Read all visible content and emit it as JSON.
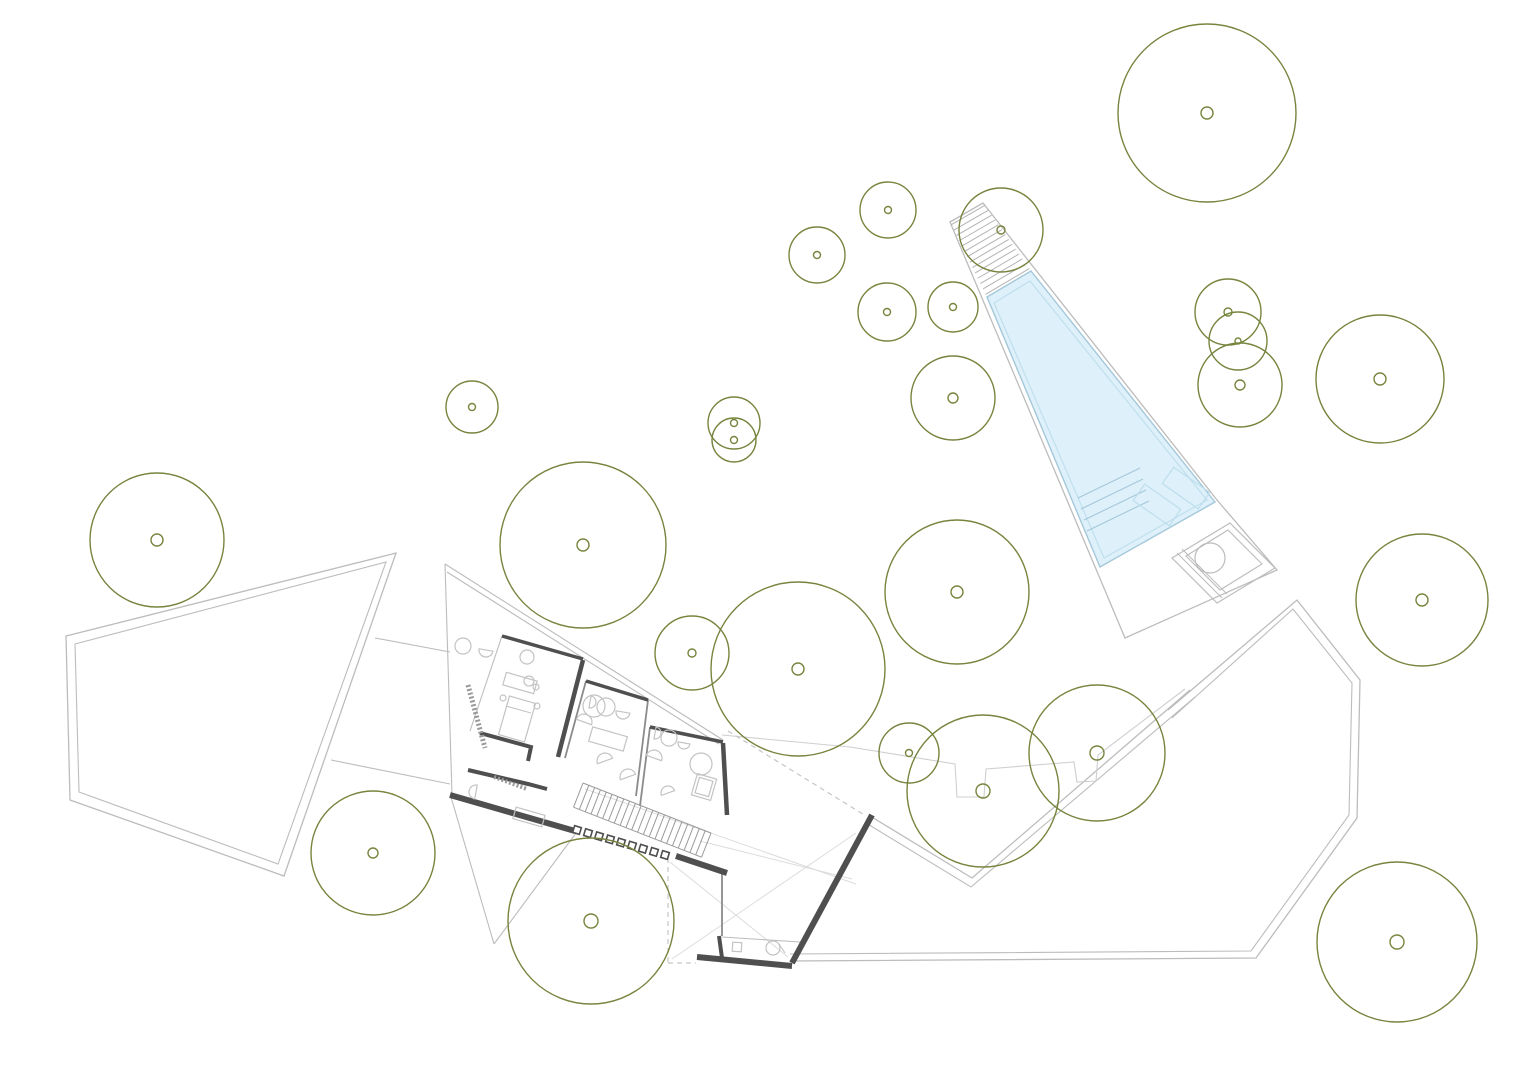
{
  "canvas": {
    "width": 1536,
    "height": 1086,
    "background": "#ffffff"
  },
  "colors": {
    "tree": "#76853e",
    "site": "#bcbcbc",
    "site_light": "#cfcfcf",
    "faint": "#dcdcdc",
    "dash": "#c6c6c6",
    "wall_dark": "#4f4f4f",
    "wall_med": "#8b8b8b",
    "furniture": "#c3c3c3",
    "water_fill": "#def0f9",
    "water_stroke": "#a4c8da",
    "water_inner": "#bedeed",
    "hatch": "#b3b3b3",
    "stair": "#9a9a9a"
  },
  "trees": [
    {
      "cx": 1207,
      "cy": 113,
      "r": 89,
      "dot": 6
    },
    {
      "cx": 888,
      "cy": 210,
      "r": 28,
      "dot": 3.5
    },
    {
      "cx": 817,
      "cy": 255,
      "r": 28,
      "dot": 3.5
    },
    {
      "cx": 887,
      "cy": 312,
      "r": 29,
      "dot": 3.5
    },
    {
      "cx": 953,
      "cy": 307,
      "r": 25,
      "dot": 3.5
    },
    {
      "cx": 1001,
      "cy": 230,
      "r": 42,
      "dot": 4
    },
    {
      "cx": 953,
      "cy": 398,
      "r": 42,
      "dot": 5
    },
    {
      "cx": 734,
      "cy": 423,
      "r": 26,
      "dot": 3.5
    },
    {
      "cx": 734,
      "cy": 440,
      "r": 22,
      "dot": 3.5
    },
    {
      "cx": 472,
      "cy": 407,
      "r": 26,
      "dot": 3.5
    },
    {
      "cx": 1228,
      "cy": 312,
      "r": 33,
      "dot": 4
    },
    {
      "cx": 1238,
      "cy": 341,
      "r": 29,
      "dot": 3
    },
    {
      "cx": 1240,
      "cy": 385,
      "r": 42,
      "dot": 5
    },
    {
      "cx": 1380,
      "cy": 379,
      "r": 64,
      "dot": 6
    },
    {
      "cx": 157,
      "cy": 540,
      "r": 67,
      "dot": 6
    },
    {
      "cx": 583,
      "cy": 545,
      "r": 83,
      "dot": 6
    },
    {
      "cx": 957,
      "cy": 592,
      "r": 72,
      "dot": 6
    },
    {
      "cx": 1422,
      "cy": 600,
      "r": 66,
      "dot": 6
    },
    {
      "cx": 798,
      "cy": 669,
      "r": 87,
      "dot": 6
    },
    {
      "cx": 692,
      "cy": 653,
      "r": 37,
      "dot": 4
    },
    {
      "cx": 983,
      "cy": 791,
      "r": 76,
      "dot": 7
    },
    {
      "cx": 1097,
      "cy": 753,
      "r": 68,
      "dot": 7
    },
    {
      "cx": 909,
      "cy": 753,
      "r": 30,
      "dot": 3.5
    },
    {
      "cx": 373,
      "cy": 853,
      "r": 62,
      "dot": 5
    },
    {
      "cx": 591,
      "cy": 921,
      "r": 83,
      "dot": 7
    },
    {
      "cx": 1397,
      "cy": 942,
      "r": 80,
      "dot": 7
    }
  ],
  "site": {
    "left_terrace_outer": [
      [
        66,
        636
      ],
      [
        396,
        553
      ],
      [
        284,
        876
      ],
      [
        70,
        800
      ]
    ],
    "left_terrace_inner": [
      [
        75,
        644
      ],
      [
        386,
        562
      ],
      [
        278,
        864
      ],
      [
        79,
        792
      ]
    ],
    "path_lines": [
      [
        [
          375,
          638
        ],
        [
          450,
          652
        ]
      ],
      [
        [
          331,
          760
        ],
        [
          450,
          784
        ]
      ]
    ],
    "right_terrace_outer": [
      [
        1168,
        710
      ],
      [
        1297,
        600
      ],
      [
        1360,
        680
      ],
      [
        1357,
        818
      ],
      [
        1256,
        958
      ],
      [
        790,
        961
      ]
    ],
    "right_terrace_inner": [
      [
        1172,
        718
      ],
      [
        1293,
        609
      ],
      [
        1352,
        683
      ],
      [
        1349,
        815
      ],
      [
        1251,
        951
      ],
      [
        790,
        954
      ]
    ],
    "upper_edge_outer": [
      [
        870,
        816
      ],
      [
        972,
        878
      ],
      [
        1190,
        690
      ]
    ],
    "upper_edge_inner": [
      [
        866,
        823
      ],
      [
        971,
        887
      ],
      [
        1195,
        697
      ]
    ],
    "notched_edge": [
      [
        722,
        735
      ],
      [
        850,
        747
      ],
      [
        955,
        764
      ],
      [
        957,
        797
      ],
      [
        984,
        797
      ],
      [
        986,
        769
      ],
      [
        1074,
        762
      ],
      [
        1077,
        782
      ],
      [
        1096,
        781
      ],
      [
        1098,
        755
      ],
      [
        1185,
        689
      ]
    ],
    "faint_lines": [
      [
        [
          585,
          789
        ],
        [
          856,
          884
        ]
      ],
      [
        [
          700,
          841
        ],
        [
          852,
          879
        ]
      ],
      [
        [
          670,
          862
        ],
        [
          788,
          957
        ]
      ],
      [
        [
          672,
          959
        ],
        [
          856,
          833
        ]
      ]
    ],
    "dashed_lines": [
      [
        [
          728,
          731
        ],
        [
          866,
          816
        ]
      ],
      [
        [
          668,
          858
        ],
        [
          668,
          963
        ]
      ],
      [
        [
          668,
          963
        ],
        [
          696,
          963
        ]
      ],
      [
        [
          977,
          281
        ],
        [
          1020,
          259
        ]
      ]
    ]
  },
  "pool": {
    "deck": [
      [
        950,
        222
      ],
      [
        983,
        203
      ],
      [
        1217,
        500
      ],
      [
        1277,
        570
      ],
      [
        1125,
        638
      ]
    ],
    "water": [
      [
        987,
        297
      ],
      [
        1031,
        271
      ],
      [
        1215,
        502
      ],
      [
        1100,
        567
      ]
    ],
    "water_inner": [
      [
        994,
        303
      ],
      [
        1030,
        281
      ],
      [
        1207,
        500
      ],
      [
        1104,
        558
      ]
    ],
    "ramp_hatch": {
      "top_edge": [
        [
          950,
          222
        ],
        [
          983,
          203
        ]
      ],
      "bottom_edge": [
        [
          987,
          297
        ],
        [
          1031,
          271
        ]
      ],
      "lines": 14
    },
    "steps": [
      [
        [
          1078,
          498
        ],
        [
          1140,
          468
        ]
      ],
      [
        [
          1081,
          509
        ],
        [
          1143,
          479
        ]
      ],
      [
        [
          1084,
          520
        ],
        [
          1146,
          490
        ]
      ],
      [
        [
          1087,
          531
        ],
        [
          1149,
          501
        ]
      ]
    ],
    "benches": [
      {
        "cx": 1157,
        "cy": 505,
        "w": 20,
        "h": 44,
        "rot": -55
      },
      {
        "cx": 1186,
        "cy": 488,
        "w": 20,
        "h": 44,
        "rot": -55
      }
    ],
    "spa": {
      "outer": [
        [
          1172,
          558
        ],
        [
          1230,
          523
        ],
        [
          1275,
          568
        ],
        [
          1217,
          603
        ]
      ],
      "inner": [
        [
          1186,
          556
        ],
        [
          1228,
          530
        ],
        [
          1262,
          564
        ],
        [
          1220,
          590
        ]
      ],
      "circle": {
        "cx": 1210,
        "cy": 558,
        "r": 15
      },
      "lines": [
        [
          [
            1177,
            553
          ],
          [
            1222,
            598
          ]
        ],
        [
          [
            1182,
            549
          ],
          [
            1227,
            594
          ]
        ]
      ]
    }
  },
  "building": {
    "outline_lines": [
      [
        [
          445,
          564
        ],
        [
          723,
          740
        ]
      ],
      [
        [
          447,
          572
        ],
        [
          719,
          744
        ]
      ],
      [
        [
          445,
          564
        ],
        [
          452,
          795
        ]
      ],
      [
        [
          451,
          797
        ],
        [
          494,
          944
        ]
      ],
      [
        [
          494,
          944
        ],
        [
          576,
          833
        ]
      ],
      [
        [
          502,
          636
        ],
        [
          470,
          731
        ]
      ],
      [
        [
          722,
          937
        ],
        [
          800,
          942
        ]
      ]
    ],
    "medium_walls": [
      [
        [
          586,
          681
        ],
        [
          565,
          758
        ]
      ],
      [
        [
          648,
          700
        ],
        [
          636,
          796
        ]
      ],
      [
        [
          650,
          727
        ],
        [
          640,
          806
        ]
      ],
      [
        [
          722,
          874
        ],
        [
          722,
          936
        ]
      ]
    ],
    "thick_walls": [
      {
        "pts": [
          [
            502,
            636
          ],
          [
            583,
            659
          ]
        ],
        "w": 3.5
      },
      {
        "pts": [
          [
            583,
            660
          ],
          [
            558,
            757
          ]
        ],
        "w": 4.5
      },
      {
        "pts": [
          [
            480,
            733
          ],
          [
            531,
            747
          ],
          [
            528,
            761
          ]
        ],
        "w": 4
      },
      {
        "pts": [
          [
            468,
            770
          ],
          [
            528,
            784
          ],
          [
            547,
            789
          ]
        ],
        "w": 4
      },
      {
        "pts": [
          [
            586,
            681
          ],
          [
            648,
            700
          ]
        ],
        "w": 3.5
      },
      {
        "pts": [
          [
            650,
            727
          ],
          [
            723,
            742
          ]
        ],
        "w": 3.5
      },
      {
        "pts": [
          [
            723,
            743
          ],
          [
            727,
            815
          ]
        ],
        "w": 4.5
      },
      {
        "pts": [
          [
            450,
            795
          ],
          [
            575,
            831
          ]
        ],
        "w": 6
      },
      {
        "pts": [
          [
            676,
            856
          ],
          [
            727,
            873
          ]
        ],
        "w": 6
      },
      {
        "pts": [
          [
            872,
            815
          ],
          [
            792,
            963
          ]
        ],
        "w": 6
      },
      {
        "pts": [
          [
            697,
            957
          ],
          [
            792,
            966
          ]
        ],
        "w": 6
      },
      {
        "pts": [
          [
            719,
            936
          ],
          [
            722,
            958
          ]
        ],
        "w": 4
      }
    ],
    "hatched_strips": [
      {
        "pts": [
          [
            468,
            685
          ],
          [
            485,
            748
          ]
        ],
        "w": 5
      },
      {
        "pts": [
          [
            494,
            777
          ],
          [
            527,
            789
          ]
        ],
        "w": 4
      }
    ],
    "stairs": {
      "p1": [
        583,
        783
      ],
      "p2": [
        711,
        833
      ],
      "width": 26,
      "treads": 22
    },
    "columns": {
      "start": [
        577,
        830
      ],
      "end": [
        665,
        855
      ],
      "count": 9,
      "size": 7,
      "rot": 17
    },
    "furniture_circles": [
      [
        463,
        646,
        8
      ],
      [
        527,
        657,
        7
      ],
      [
        529,
        681,
        5
      ],
      [
        536,
        687,
        3
      ],
      [
        503,
        698,
        3
      ],
      [
        537,
        706,
        3
      ],
      [
        594,
        706,
        11
      ],
      [
        606,
        707,
        9
      ],
      [
        669,
        738,
        8
      ],
      [
        701,
        764,
        11
      ],
      [
        773,
        948,
        7
      ]
    ],
    "d_shapes": [
      [
        486,
        650,
        7,
        10
      ],
      [
        584,
        722,
        8,
        200
      ],
      [
        605,
        761,
        8,
        160
      ],
      [
        628,
        777,
        8,
        160
      ],
      [
        654,
        758,
        8,
        200
      ],
      [
        668,
        793,
        7,
        160
      ],
      [
        476,
        792,
        7,
        100
      ],
      [
        590,
        702,
        6,
        280
      ],
      [
        623,
        712,
        7,
        10
      ],
      [
        655,
        733,
        6,
        280
      ],
      [
        684,
        743,
        6,
        10
      ]
    ],
    "rects": [
      {
        "cx": 520,
        "cy": 683,
        "w": 32,
        "h": 13,
        "rot": 16
      },
      {
        "cx": 517,
        "cy": 719,
        "w": 27,
        "h": 40,
        "rot": 16
      },
      {
        "cx": 529,
        "cy": 817,
        "w": 30,
        "h": 12,
        "rot": 16
      },
      {
        "cx": 608,
        "cy": 739,
        "w": 36,
        "h": 15,
        "rot": 16
      },
      {
        "cx": 704,
        "cy": 787,
        "w": 20,
        "h": 22,
        "rot": 16
      },
      {
        "cx": 704,
        "cy": 787,
        "w": 14,
        "h": 16,
        "rot": 16
      },
      {
        "cx": 737,
        "cy": 947,
        "w": 9,
        "h": 9,
        "rot": 3
      }
    ],
    "detail_lines": [
      [
        [
          506,
          706
        ],
        [
          531,
          713
        ]
      ],
      [
        [
          779,
          944
        ],
        [
          785,
          953
        ]
      ]
    ]
  }
}
